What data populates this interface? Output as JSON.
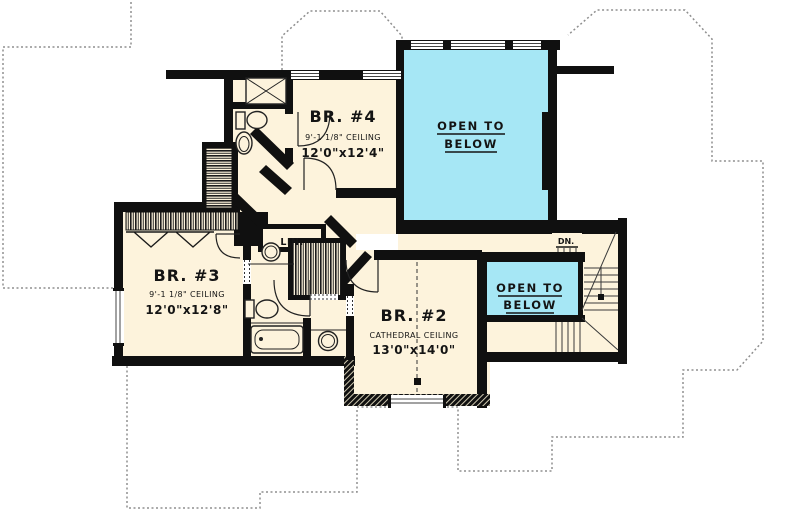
{
  "plan": {
    "rooms": {
      "br4": {
        "name": "BR. #4",
        "ceiling": "9'-1 1/8\" CEILING",
        "size": "12'0\"x12'4\""
      },
      "br3": {
        "name": "BR. #3",
        "ceiling": "9'-1 1/8\" CEILING",
        "size": "12'0\"x12'8\""
      },
      "br2": {
        "name": "BR. #2",
        "ceiling": "CATHEDRAL CEILING",
        "size": "13'0\"x14'0\""
      },
      "open_to_below_large": {
        "line1": "OPEN TO",
        "line2": "BELOW"
      },
      "open_to_below_small": {
        "line1": "OPEN TO",
        "line2": "BELOW"
      },
      "linen_closet": {
        "label": "LIN."
      },
      "stairs": {
        "label": "DN."
      }
    },
    "colors": {
      "floor": "#fdf3dc",
      "open_to_below": "#a6e7f5",
      "walls": "#101010",
      "roof_outline": "#8f8f8f"
    }
  }
}
